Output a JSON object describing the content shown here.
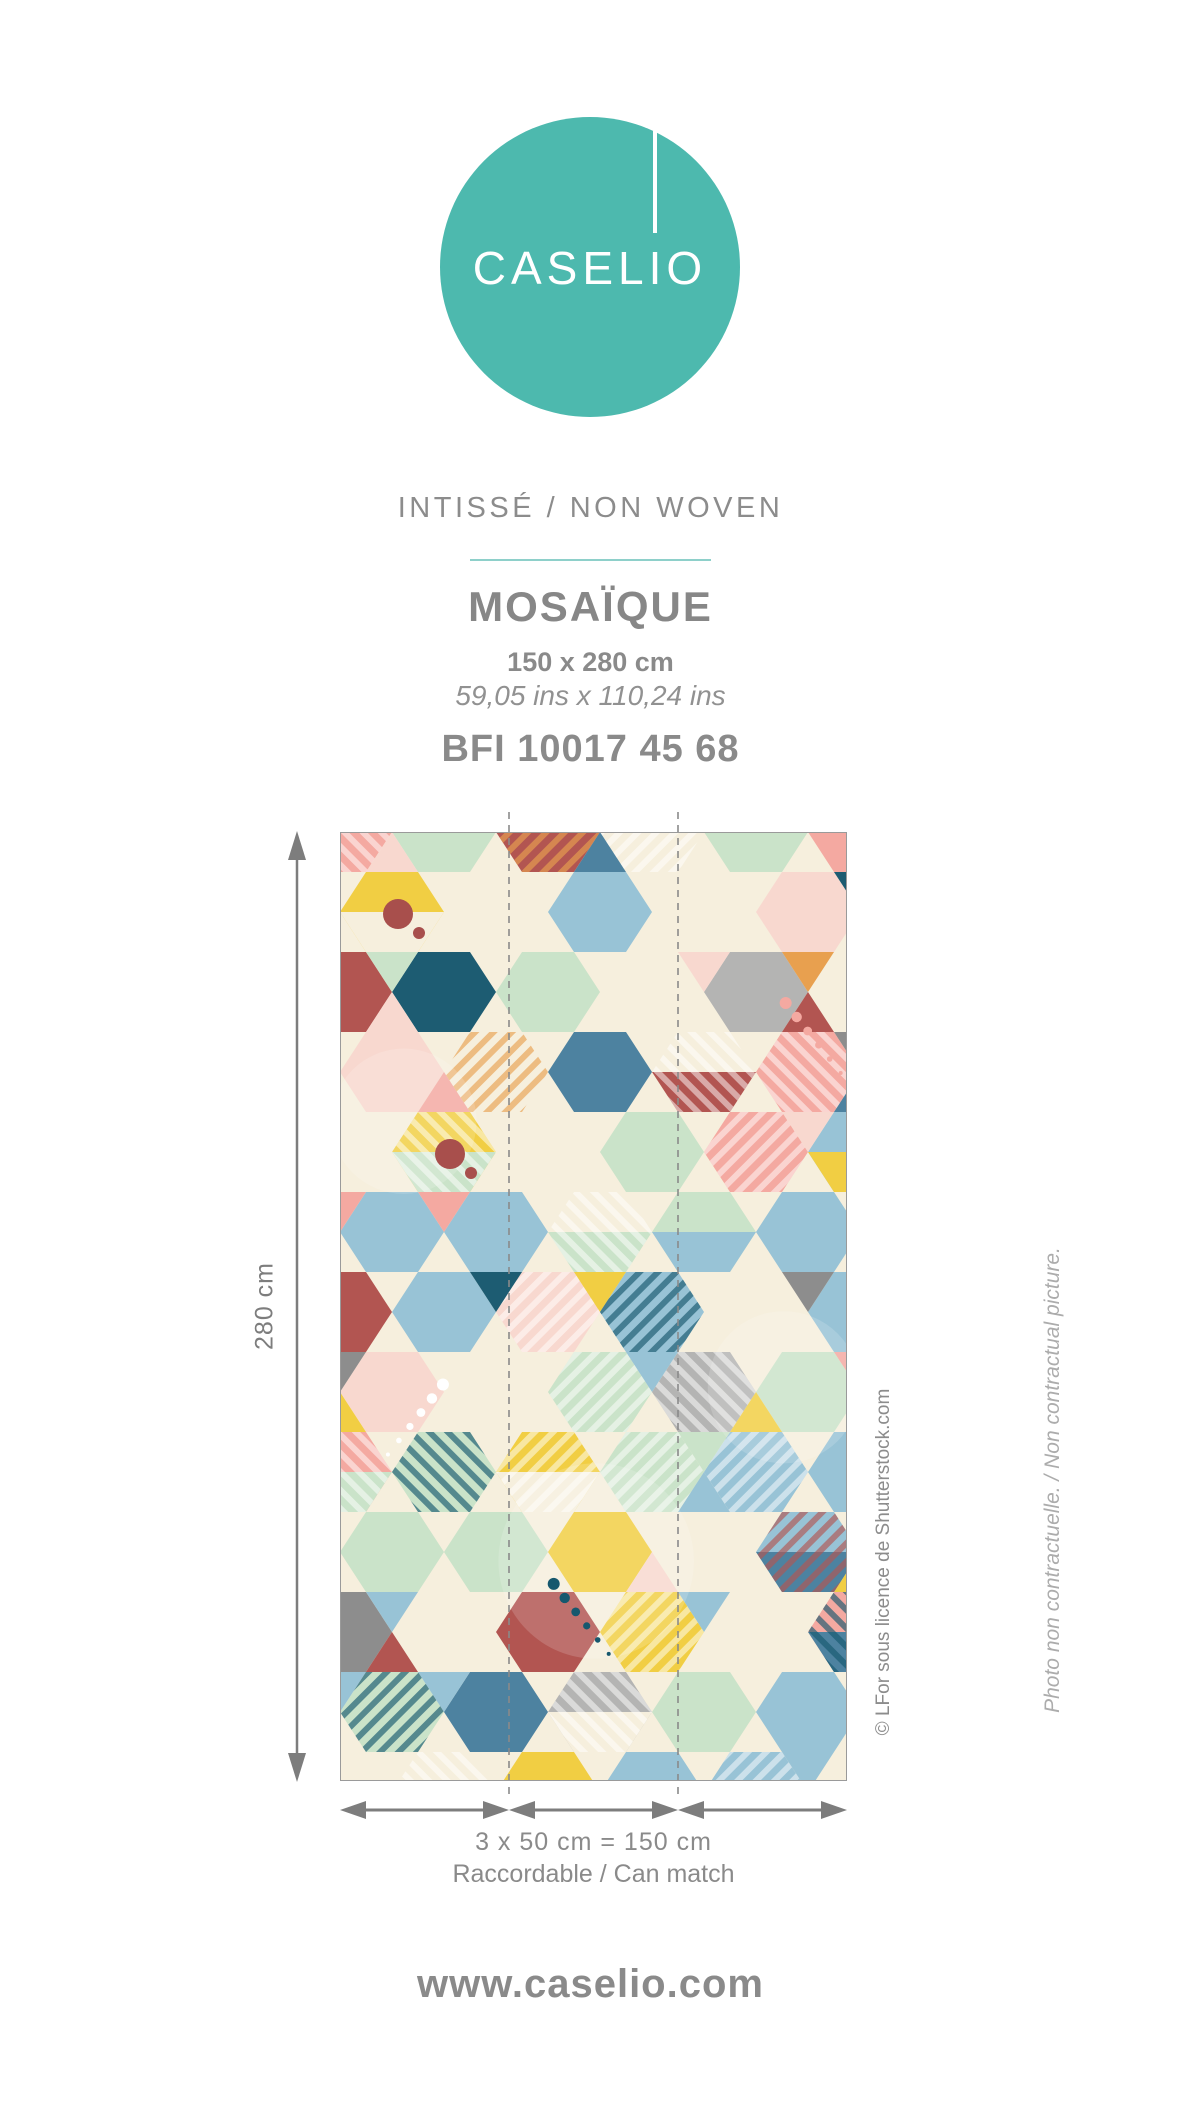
{
  "logo": {
    "brand": "CASELIO"
  },
  "header": {
    "material": "INTISSÉ / NON WOVEN",
    "product_name": "MOSAÏQUE",
    "size_cm": "150 x 280 cm",
    "size_ins": "59,05 ins x 110,24 ins",
    "reference": "BFI 10017 45 68"
  },
  "preview": {
    "height_label": "280 cm",
    "width_label": "3 x 50 cm = 150 cm",
    "match_label": "Raccordable / Can match",
    "credit": "© LFor sous licence de Shutterstock.com",
    "disclaimer": "Photo non contractuelle. / Non contractual picture.",
    "panels": 3,
    "wallpaper": {
      "background": "#f6efdd",
      "border_color": "#9a9a9a",
      "guide_color": "#8a8a8a",
      "seed": 11,
      "palette": [
        {
          "c": "#f6efdd",
          "w": 5.2
        },
        {
          "c": "#98c3d6",
          "w": 2.2
        },
        {
          "c": "#f4a9a1",
          "w": 1.6
        },
        {
          "c": "#f8d8cf",
          "w": 1.3
        },
        {
          "c": "#cae3c9",
          "w": 1.3
        },
        {
          "c": "#f1ce43",
          "w": 1.3
        },
        {
          "c": "#1d5c72",
          "w": 1.0
        },
        {
          "c": "#4d82a0",
          "w": 0.7
        },
        {
          "c": "#b25551",
          "w": 1.0
        },
        {
          "c": "#8d8d8d",
          "w": 0.9
        },
        {
          "c": "#b4b4b3",
          "w": 0.6
        },
        {
          "c": "#e8a04f",
          "w": 0.3
        }
      ],
      "stripe_colors": [
        "#ffffff",
        "#16586e",
        "#e8a04f",
        "#b25551"
      ],
      "accent_dot_color": "#a84f4c",
      "dot_trail_colors": [
        "#ffffff",
        "#16586e",
        "#f4a9a1"
      ]
    }
  },
  "colors": {
    "logo_teal": "#4db9ae",
    "divider_teal": "#8ed0ca",
    "text_gray": "#8a8a8a",
    "arrow_gray": "#7d7d7d"
  },
  "footer": {
    "website": "www.caselio.com"
  }
}
